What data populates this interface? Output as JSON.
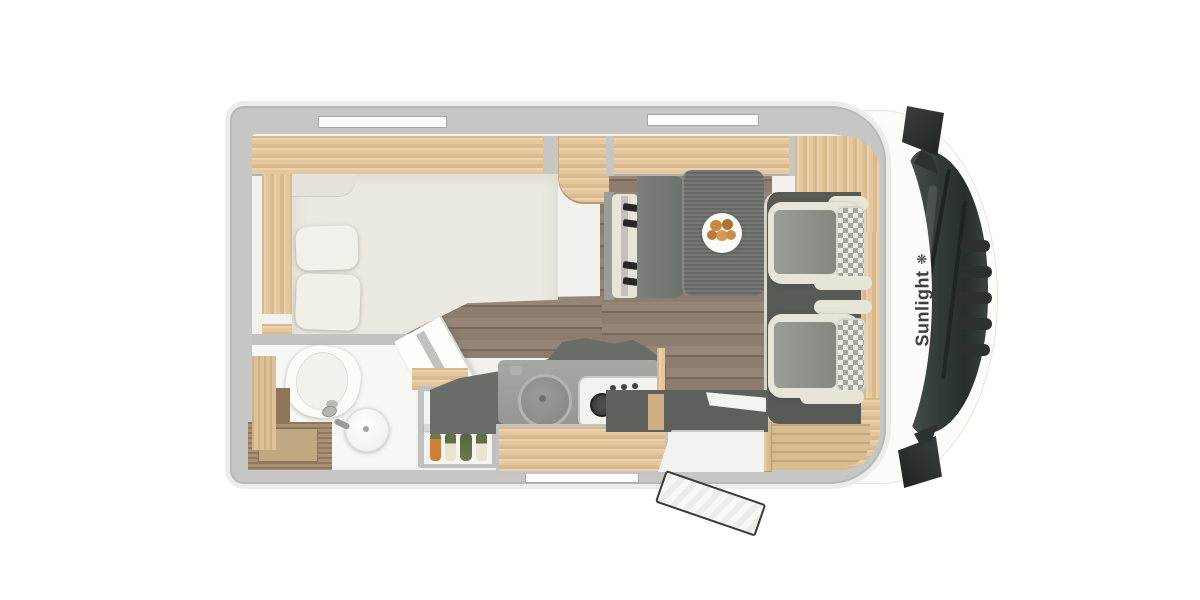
{
  "meta": {
    "description": "Top-down floor plan rendering of a Sunlight motorhome (cab facing right)",
    "background": "#ffffff"
  },
  "branding": {
    "text": "Sunlight",
    "icon": "sunlight-flower-icon",
    "icon_glyph": "❋",
    "text_color": "#3b3e3c"
  },
  "colors": {
    "wall": "#c6c7c5",
    "body_skin": "#ececea",
    "interior": "#f2f1ed",
    "wood": "#e4c79d",
    "wood_dark": "#a38869",
    "floor": "#8d7d6e",
    "dark_gray": "#6e716d",
    "cab_floor": "#585a56",
    "upholstery": "#e7e4d8",
    "seat_panel": "#90938c",
    "glass": "#333b37",
    "mirror": "#2d312f",
    "brand_text": "#3b3e3c",
    "carrot": "#cd7f35",
    "leek_green": "#5f7046",
    "plate_food": "#c9873f"
  }
}
